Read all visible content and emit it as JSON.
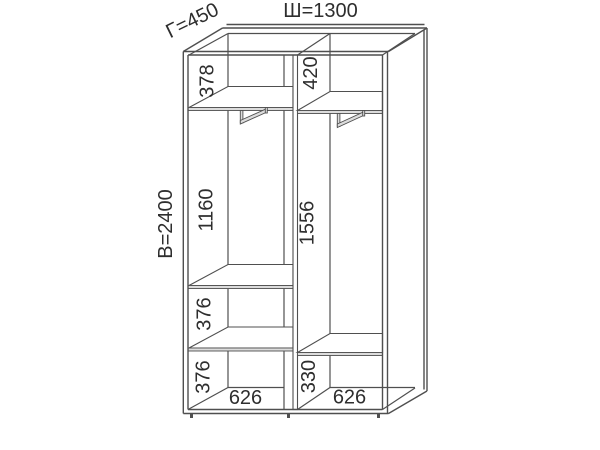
{
  "drawing": {
    "title": "wardrobe-dimension-diagram",
    "overall": {
      "width_label": "Ш=1300",
      "depth_label": "Г=450",
      "height_label": "В=2400"
    },
    "left_compartment": {
      "top_section_height": "378",
      "hanging_section_height": "1160",
      "shelf_section_height": "376",
      "bottom_section_height": "376",
      "width": "626"
    },
    "right_compartment": {
      "top_section_height": "420",
      "hanging_section_height": "1556",
      "bottom_section_height": "330",
      "width": "626"
    },
    "colors": {
      "line": "#4f4f4f",
      "text": "#2e2e2e",
      "background": "#ffffff",
      "shelf_fill": "#dcdcdc"
    }
  }
}
